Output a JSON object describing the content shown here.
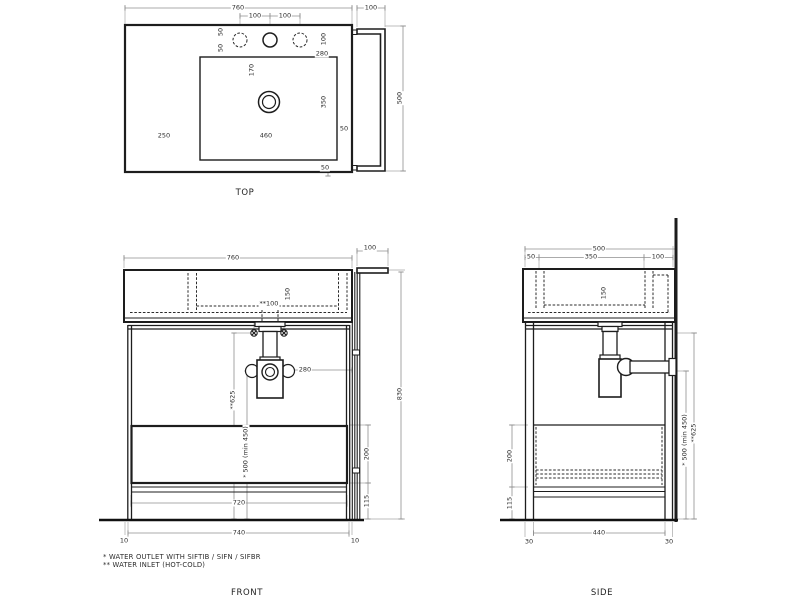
{
  "top_view": {
    "label": "TOP",
    "dims": {
      "width": "760",
      "rail_width": "100",
      "hole_pitch_left": "100",
      "hole_pitch_right": "100",
      "back_offset_50": "50",
      "bowl_offset_50": "50",
      "corner_100": "100",
      "faucet_280": "280",
      "drain_170": "170",
      "bowl_350": "350",
      "left_250": "250",
      "bowl_460": "460",
      "right_50": "50",
      "bottom_50": "50",
      "depth_500": "500"
    }
  },
  "front_view": {
    "label": "FRONT",
    "dims": {
      "width": "760",
      "rail_width": "100",
      "bowl_depth_150": "150",
      "inlet_pitch": "**100",
      "trap_280": "280",
      "inlet_height": "**625",
      "outlet_height": "* 500 (min 450)",
      "height_830": "830",
      "drawer_200": "200",
      "base_115": "115",
      "inner_720": "720",
      "frame_740": "740",
      "left_10": "10",
      "right_10": "10"
    }
  },
  "side_view": {
    "label": "SIDE",
    "dims": {
      "depth_500": "500",
      "front_50": "50",
      "bowl_350": "350",
      "back_100": "100",
      "bowl_depth_150": "150",
      "drawer_200": "200",
      "base_115": "115",
      "inner_440": "440",
      "left_30": "30",
      "right_30": "30",
      "outlet_height": "* 500 (min 450)",
      "inlet_height": "**625"
    }
  },
  "footnotes": {
    "water_outlet": "*  WATER OUTLET WITH SIFTIB / SIFN / SIFBR",
    "water_inlet": "** WATER INLET (HOT-COLD)"
  }
}
